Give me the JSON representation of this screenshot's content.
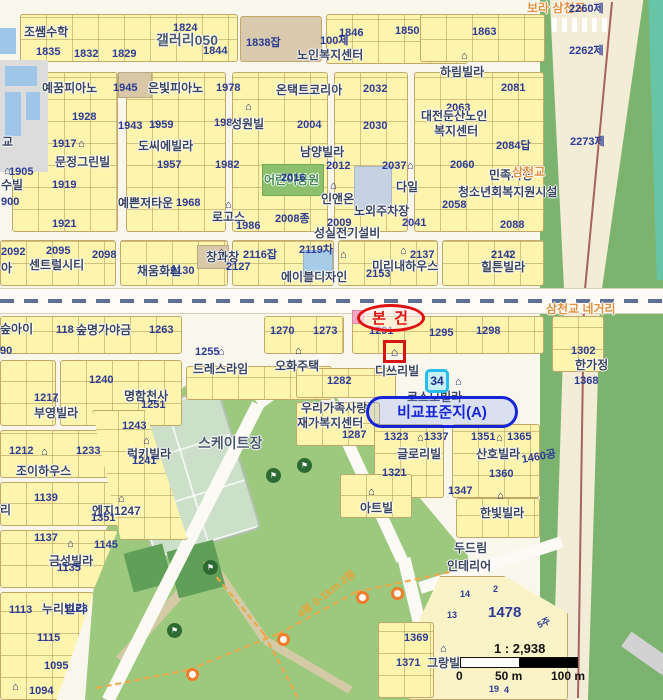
{
  "map": {
    "annotations": {
      "subject": "본 건",
      "comparison": "비교표준지(A)",
      "bus_badge": "34",
      "subject_marker_glyph": "⌂"
    },
    "scale": {
      "ratio": "1 : 2,938",
      "ticks": [
        "0",
        "50 m",
        "100 m"
      ]
    },
    "colors": {
      "subject_red": "#e01010",
      "comparison_blue": "#1526d8",
      "highlight_cyan": "#27bdf0",
      "parcel_number_navy": "#2b3b96",
      "road_label_orange": "#e2903d",
      "parcel_yellow": "#fdf5ae",
      "park_green": "#9cc97e"
    },
    "labels": [
      {
        "t": "조쌤수학",
        "x": 24,
        "y": 26,
        "c": "place"
      },
      {
        "t": "1824",
        "x": 173,
        "y": 23,
        "c": "num"
      },
      {
        "t": "갤러리050",
        "x": 156,
        "y": 33,
        "c": "big"
      },
      {
        "t": "1835",
        "x": 36,
        "y": 47,
        "c": "num"
      },
      {
        "t": "1832",
        "x": 74,
        "y": 49,
        "c": "num"
      },
      {
        "t": "1829",
        "x": 112,
        "y": 49,
        "c": "num"
      },
      {
        "t": "1844",
        "x": 203,
        "y": 46,
        "c": "num"
      },
      {
        "t": "1838잡",
        "x": 246,
        "y": 38,
        "c": "num"
      },
      {
        "t": "100제",
        "x": 320,
        "y": 36,
        "c": "num"
      },
      {
        "t": "1846",
        "x": 339,
        "y": 28,
        "c": "num"
      },
      {
        "t": "1850",
        "x": 395,
        "y": 26,
        "c": "num"
      },
      {
        "t": "1863",
        "x": 472,
        "y": 27,
        "c": "num"
      },
      {
        "t": "노인복지센터",
        "x": 297,
        "y": 49,
        "c": "place"
      },
      {
        "t": "보라 삼천교",
        "x": 527,
        "y": 2,
        "c": "road"
      },
      {
        "t": "2260제",
        "x": 569,
        "y": 4,
        "c": "num"
      },
      {
        "t": "2262제",
        "x": 569,
        "y": 46,
        "c": "num"
      },
      {
        "t": "2273제",
        "x": 570,
        "y": 137,
        "c": "num"
      },
      {
        "t": "하림빌라",
        "x": 440,
        "y": 66,
        "c": "place"
      },
      {
        "t": "예꿈피아노",
        "x": 42,
        "y": 82,
        "c": "place"
      },
      {
        "t": "1945",
        "x": 113,
        "y": 83,
        "c": "num"
      },
      {
        "t": "은빛피아노",
        "x": 148,
        "y": 82,
        "c": "place"
      },
      {
        "t": "1978",
        "x": 216,
        "y": 83,
        "c": "num"
      },
      {
        "t": "온택트코리아",
        "x": 276,
        "y": 84,
        "c": "place"
      },
      {
        "t": "1928",
        "x": 72,
        "y": 112,
        "c": "num"
      },
      {
        "t": "1943",
        "x": 118,
        "y": 121,
        "c": "num"
      },
      {
        "t": "1959",
        "x": 149,
        "y": 120,
        "c": "num"
      },
      {
        "t": "1988",
        "x": 214,
        "y": 118,
        "c": "num"
      },
      {
        "t": "성원빌",
        "x": 231,
        "y": 118,
        "c": "place"
      },
      {
        "t": "2004",
        "x": 297,
        "y": 120,
        "c": "num"
      },
      {
        "t": "2032",
        "x": 363,
        "y": 84,
        "c": "num"
      },
      {
        "t": "2030",
        "x": 363,
        "y": 121,
        "c": "num"
      },
      {
        "t": "2081",
        "x": 501,
        "y": 83,
        "c": "num"
      },
      {
        "t": "2063",
        "x": 446,
        "y": 103,
        "c": "num"
      },
      {
        "t": "대전둔산노인",
        "x": 421,
        "y": 110,
        "c": "place"
      },
      {
        "t": "복지센터",
        "x": 434,
        "y": 125,
        "c": "place"
      },
      {
        "t": "2084답",
        "x": 496,
        "y": 141,
        "c": "num"
      },
      {
        "t": "도씨에빌라",
        "x": 138,
        "y": 140,
        "c": "place"
      },
      {
        "t": "1917",
        "x": 52,
        "y": 139,
        "c": "num"
      },
      {
        "t": "문정그린빌",
        "x": 55,
        "y": 156,
        "c": "place"
      },
      {
        "t": "남양빌라",
        "x": 300,
        "y": 146,
        "c": "place"
      },
      {
        "t": "1905",
        "x": 9,
        "y": 167,
        "c": "num"
      },
      {
        "t": "수빌",
        "x": 1,
        "y": 179,
        "c": "place"
      },
      {
        "t": "900",
        "x": 1,
        "y": 197,
        "c": "num"
      },
      {
        "t": "1919",
        "x": 52,
        "y": 180,
        "c": "num"
      },
      {
        "t": "1921",
        "x": 52,
        "y": 219,
        "c": "num"
      },
      {
        "t": "1957",
        "x": 157,
        "y": 160,
        "c": "num"
      },
      {
        "t": "1982",
        "x": 215,
        "y": 160,
        "c": "num"
      },
      {
        "t": "어린이공원",
        "x": 264,
        "y": 174,
        "c": "park"
      },
      {
        "t": "2016",
        "x": 281,
        "y": 173,
        "c": "num"
      },
      {
        "t": "예쁜저타운",
        "x": 118,
        "y": 197,
        "c": "place"
      },
      {
        "t": "1968",
        "x": 176,
        "y": 198,
        "c": "num"
      },
      {
        "t": "로고스",
        "x": 212,
        "y": 211,
        "c": "place"
      },
      {
        "t": "1986",
        "x": 236,
        "y": 221,
        "c": "num"
      },
      {
        "t": "2008종",
        "x": 275,
        "y": 214,
        "c": "num"
      },
      {
        "t": "인앤온",
        "x": 321,
        "y": 193,
        "c": "place"
      },
      {
        "t": "노외주차장",
        "x": 354,
        "y": 205,
        "c": "place"
      },
      {
        "t": "다일",
        "x": 396,
        "y": 181,
        "c": "place"
      },
      {
        "t": "2058",
        "x": 442,
        "y": 200,
        "c": "num"
      },
      {
        "t": "2012",
        "x": 326,
        "y": 161,
        "c": "num"
      },
      {
        "t": "2037",
        "x": 382,
        "y": 161,
        "c": "num"
      },
      {
        "t": "2060",
        "x": 450,
        "y": 160,
        "c": "num"
      },
      {
        "t": "민족사랑",
        "x": 489,
        "y": 169,
        "c": "place"
      },
      {
        "t": "삼천교",
        "x": 512,
        "y": 166,
        "c": "road"
      },
      {
        "t": "청소년회복지원시설",
        "x": 458,
        "y": 186,
        "c": "place"
      },
      {
        "t": "2009",
        "x": 327,
        "y": 218,
        "c": "num"
      },
      {
        "t": "성실전기설비",
        "x": 314,
        "y": 227,
        "c": "place"
      },
      {
        "t": "2041",
        "x": 402,
        "y": 218,
        "c": "num"
      },
      {
        "t": "2088",
        "x": 500,
        "y": 220,
        "c": "num"
      },
      {
        "t": "2092",
        "x": 1,
        "y": 247,
        "c": "num"
      },
      {
        "t": "2095",
        "x": 46,
        "y": 246,
        "c": "num"
      },
      {
        "t": "2098",
        "x": 92,
        "y": 250,
        "c": "num"
      },
      {
        "t": "센트럴시티",
        "x": 29,
        "y": 259,
        "c": "place"
      },
      {
        "t": "아",
        "x": 1,
        "y": 262,
        "c": "place"
      },
      {
        "t": "채움화실",
        "x": 137,
        "y": 265,
        "c": "place"
      },
      {
        "t": "2130",
        "x": 170,
        "y": 266,
        "c": "num"
      },
      {
        "t": "창과창",
        "x": 206,
        "y": 251,
        "c": "place"
      },
      {
        "t": "2116잡",
        "x": 243,
        "y": 250,
        "c": "num"
      },
      {
        "t": "2127",
        "x": 226,
        "y": 262,
        "c": "num"
      },
      {
        "t": "2119차",
        "x": 299,
        "y": 245,
        "c": "num"
      },
      {
        "t": "미리내하우스",
        "x": 372,
        "y": 260,
        "c": "place"
      },
      {
        "t": "2137",
        "x": 410,
        "y": 250,
        "c": "num"
      },
      {
        "t": "2153",
        "x": 366,
        "y": 269,
        "c": "num"
      },
      {
        "t": "2142",
        "x": 491,
        "y": 250,
        "c": "num"
      },
      {
        "t": "힐튼빌라",
        "x": 481,
        "y": 261,
        "c": "place"
      },
      {
        "t": "에이블디자인",
        "x": 281,
        "y": 271,
        "c": "place"
      },
      {
        "t": "삼천교 네거리",
        "x": 546,
        "y": 303,
        "c": "road"
      },
      {
        "t": "숲아이",
        "x": 0,
        "y": 323,
        "c": "place"
      },
      {
        "t": "118",
        "x": 56,
        "y": 325,
        "c": "num"
      },
      {
        "t": "숲명가야금",
        "x": 76,
        "y": 324,
        "c": "place"
      },
      {
        "t": "1263",
        "x": 149,
        "y": 325,
        "c": "num"
      },
      {
        "t": "1270",
        "x": 270,
        "y": 326,
        "c": "num"
      },
      {
        "t": "1273",
        "x": 313,
        "y": 326,
        "c": "num"
      },
      {
        "t": "1291",
        "x": 369,
        "y": 326,
        "c": "num"
      },
      {
        "t": "1295",
        "x": 429,
        "y": 328,
        "c": "num"
      },
      {
        "t": "1298",
        "x": 476,
        "y": 326,
        "c": "num"
      },
      {
        "t": "1302",
        "x": 571,
        "y": 346,
        "c": "num"
      },
      {
        "t": "90",
        "x": 0,
        "y": 346,
        "c": "num"
      },
      {
        "t": "1255",
        "x": 195,
        "y": 347,
        "c": "num"
      },
      {
        "t": "드레스라임",
        "x": 193,
        "y": 363,
        "c": "place"
      },
      {
        "t": "오화주택",
        "x": 275,
        "y": 360,
        "c": "place"
      },
      {
        "t": "디쓰리빌",
        "x": 375,
        "y": 365,
        "c": "place"
      },
      {
        "t": "한가정",
        "x": 575,
        "y": 359,
        "c": "place"
      },
      {
        "t": "1282",
        "x": 327,
        "y": 376,
        "c": "num"
      },
      {
        "t": "1368",
        "x": 574,
        "y": 376,
        "c": "num"
      },
      {
        "t": "코스모빌라",
        "x": 407,
        "y": 391,
        "c": "place"
      },
      {
        "t": "1240",
        "x": 89,
        "y": 375,
        "c": "num"
      },
      {
        "t": "1217",
        "x": 34,
        "y": 393,
        "c": "num"
      },
      {
        "t": "부영빌라",
        "x": 34,
        "y": 407,
        "c": "place"
      },
      {
        "t": "명함천사",
        "x": 124,
        "y": 390,
        "c": "place"
      },
      {
        "t": "1251",
        "x": 141,
        "y": 400,
        "c": "num"
      },
      {
        "t": "우리가족사랑",
        "x": 301,
        "y": 402,
        "c": "place"
      },
      {
        "t": "재가복지센터",
        "x": 297,
        "y": 417,
        "c": "place"
      },
      {
        "t": "1287",
        "x": 342,
        "y": 430,
        "c": "num"
      },
      {
        "t": "1323",
        "x": 384,
        "y": 432,
        "c": "num"
      },
      {
        "t": "1337",
        "x": 424,
        "y": 432,
        "c": "num"
      },
      {
        "t": "1351",
        "x": 471,
        "y": 432,
        "c": "num"
      },
      {
        "t": "1365",
        "x": 507,
        "y": 432,
        "c": "num"
      },
      {
        "t": "글로리빌",
        "x": 397,
        "y": 448,
        "c": "place"
      },
      {
        "t": "산호빌라",
        "x": 476,
        "y": 448,
        "c": "place"
      },
      {
        "t": "1460공",
        "x": 521,
        "y": 455,
        "c": "num",
        "r": -10
      },
      {
        "t": "1321",
        "x": 382,
        "y": 468,
        "c": "num"
      },
      {
        "t": "1360",
        "x": 489,
        "y": 469,
        "c": "num"
      },
      {
        "t": "1347",
        "x": 448,
        "y": 486,
        "c": "num"
      },
      {
        "t": "아트빌",
        "x": 360,
        "y": 502,
        "c": "place"
      },
      {
        "t": "한빛빌라",
        "x": 480,
        "y": 507,
        "c": "place"
      },
      {
        "t": "두드림",
        "x": 454,
        "y": 542,
        "c": "place"
      },
      {
        "t": "인테리어",
        "x": 447,
        "y": 560,
        "c": "place"
      },
      {
        "t": "1212",
        "x": 9,
        "y": 446,
        "c": "num"
      },
      {
        "t": "1233",
        "x": 76,
        "y": 446,
        "c": "num"
      },
      {
        "t": "조이하우스",
        "x": 16,
        "y": 465,
        "c": "place"
      },
      {
        "t": "1139",
        "x": 34,
        "y": 493,
        "c": "num"
      },
      {
        "t": "리",
        "x": 0,
        "y": 504,
        "c": "place"
      },
      {
        "t": "1137",
        "x": 34,
        "y": 533,
        "c": "num"
      },
      {
        "t": "1145",
        "x": 94,
        "y": 540,
        "c": "num"
      },
      {
        "t": "금성빌라",
        "x": 49,
        "y": 555,
        "c": "place"
      },
      {
        "t": "1135",
        "x": 57,
        "y": 563,
        "c": "num"
      },
      {
        "t": "1243",
        "x": 122,
        "y": 421,
        "c": "num"
      },
      {
        "t": "럭키빌라",
        "x": 127,
        "y": 448,
        "c": "place"
      },
      {
        "t": "1241",
        "x": 132,
        "y": 456,
        "c": "num"
      },
      {
        "t": "엔지1247",
        "x": 92,
        "y": 505,
        "c": "place"
      },
      {
        "t": "1351",
        "x": 91,
        "y": 513,
        "c": "num"
      },
      {
        "t": "스케이트장",
        "x": 198,
        "y": 436,
        "c": "big"
      },
      {
        "t": "1113",
        "x": 9,
        "y": 605,
        "c": "num"
      },
      {
        "t": "누리빌라",
        "x": 42,
        "y": 603,
        "c": "place"
      },
      {
        "t": "1123",
        "x": 64,
        "y": 604,
        "c": "num"
      },
      {
        "t": "1115",
        "x": 37,
        "y": 633,
        "c": "num"
      },
      {
        "t": "1095",
        "x": 44,
        "y": 661,
        "c": "num"
      },
      {
        "t": "1094",
        "x": 29,
        "y": 686,
        "c": "num"
      },
      {
        "t": "1369",
        "x": 404,
        "y": 633,
        "c": "num"
      },
      {
        "t": "1371",
        "x": 396,
        "y": 658,
        "c": "num"
      },
      {
        "t": "그랑빌",
        "x": 427,
        "y": 657,
        "c": "place"
      },
      {
        "t": "1478",
        "x": 488,
        "y": 605,
        "c": "bignum"
      },
      {
        "t": "14",
        "x": 460,
        "y": 590,
        "c": "nums"
      },
      {
        "t": "2",
        "x": 493,
        "y": 585,
        "c": "nums"
      },
      {
        "t": "13",
        "x": 447,
        "y": 611,
        "c": "nums"
      },
      {
        "t": "5주",
        "x": 536,
        "y": 622,
        "c": "nums",
        "r": -25
      },
      {
        "t": "19",
        "x": 489,
        "y": 685,
        "c": "nums"
      },
      {
        "t": "4",
        "x": 504,
        "y": 686,
        "c": "nums"
      },
      {
        "t": "교",
        "x": 2,
        "y": 136,
        "c": "place"
      },
      {
        "t": "4봉 0-1km 2봉",
        "x": 296,
        "y": 612,
        "c": "trail",
        "r": -38
      }
    ],
    "building_icons": [
      {
        "x": 4,
        "y": 166
      },
      {
        "x": 78,
        "y": 139
      },
      {
        "x": 152,
        "y": 119
      },
      {
        "x": 225,
        "y": 200
      },
      {
        "x": 245,
        "y": 102
      },
      {
        "x": 330,
        "y": 181
      },
      {
        "x": 400,
        "y": 246
      },
      {
        "x": 461,
        "y": 51
      },
      {
        "x": 506,
        "y": 249
      },
      {
        "x": 407,
        "y": 161
      },
      {
        "x": 52,
        "y": 394
      },
      {
        "x": 41,
        "y": 447
      },
      {
        "x": 67,
        "y": 539
      },
      {
        "x": 118,
        "y": 494
      },
      {
        "x": 12,
        "y": 682
      },
      {
        "x": 143,
        "y": 436
      },
      {
        "x": 218,
        "y": 347
      },
      {
        "x": 295,
        "y": 346
      },
      {
        "x": 368,
        "y": 487
      },
      {
        "x": 417,
        "y": 433
      },
      {
        "x": 496,
        "y": 433
      },
      {
        "x": 497,
        "y": 491
      },
      {
        "x": 440,
        "y": 644
      },
      {
        "x": 455,
        "y": 377
      },
      {
        "x": 340,
        "y": 250
      },
      {
        "x": 218,
        "y": 247
      },
      {
        "x": 170,
        "y": 263
      }
    ],
    "flag_markers": [
      {
        "x": 266,
        "y": 468
      },
      {
        "x": 297,
        "y": 458
      },
      {
        "x": 203,
        "y": 560
      },
      {
        "x": 167,
        "y": 623
      }
    ],
    "waypoint_markers": [
      {
        "x": 356,
        "y": 591
      },
      {
        "x": 391,
        "y": 587
      },
      {
        "x": 277,
        "y": 633
      },
      {
        "x": 186,
        "y": 668
      }
    ]
  }
}
